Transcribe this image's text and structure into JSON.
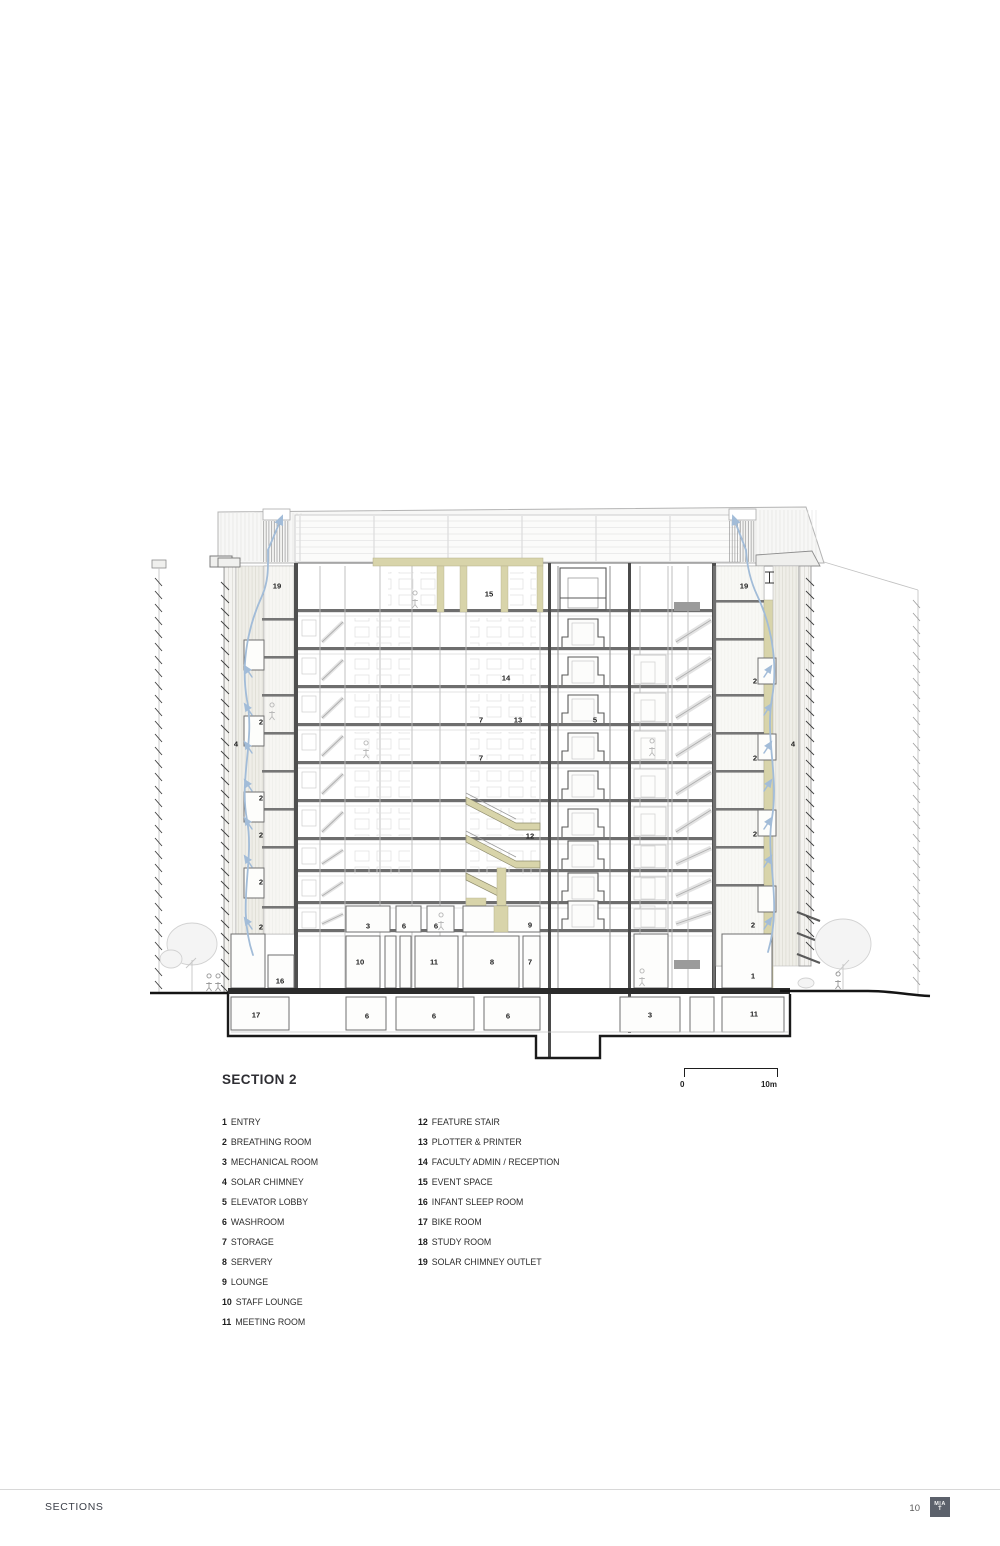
{
  "drawing": {
    "title": "SECTION 2",
    "scale_bar": {
      "start_label": "0",
      "end_label": "10m"
    },
    "colors": {
      "timber": "#d8d4aa",
      "timber_edge": "#b4b08c",
      "airflow": "#a2bcd8",
      "cut_wall": "#4f4f4f",
      "light_line": "#bcbcbc",
      "ground": "#1a1a1a"
    },
    "labels": [
      {
        "t": "19",
        "x": 277,
        "y": 586
      },
      {
        "t": "19",
        "x": 744,
        "y": 586
      },
      {
        "t": "15",
        "x": 489,
        "y": 594
      },
      {
        "t": "14",
        "x": 506,
        "y": 678
      },
      {
        "t": "2",
        "x": 261,
        "y": 722
      },
      {
        "t": "7",
        "x": 481,
        "y": 720
      },
      {
        "t": "13",
        "x": 518,
        "y": 720
      },
      {
        "t": "5",
        "x": 595,
        "y": 720
      },
      {
        "t": "2",
        "x": 755,
        "y": 681
      },
      {
        "t": "4",
        "x": 236,
        "y": 744
      },
      {
        "t": "4",
        "x": 793,
        "y": 744
      },
      {
        "t": "7",
        "x": 481,
        "y": 758
      },
      {
        "t": "2",
        "x": 755,
        "y": 758
      },
      {
        "t": "2",
        "x": 261,
        "y": 798
      },
      {
        "t": "12",
        "x": 530,
        "y": 836
      },
      {
        "t": "2",
        "x": 261,
        "y": 835
      },
      {
        "t": "2",
        "x": 755,
        "y": 834
      },
      {
        "t": "2",
        "x": 261,
        "y": 882
      },
      {
        "t": "2",
        "x": 261,
        "y": 927
      },
      {
        "t": "3",
        "x": 368,
        "y": 926
      },
      {
        "t": "6",
        "x": 404,
        "y": 926
      },
      {
        "t": "6",
        "x": 436,
        "y": 926
      },
      {
        "t": "9",
        "x": 530,
        "y": 925
      },
      {
        "t": "2",
        "x": 753,
        "y": 925
      },
      {
        "t": "10",
        "x": 360,
        "y": 962
      },
      {
        "t": "11",
        "x": 434,
        "y": 962
      },
      {
        "t": "8",
        "x": 492,
        "y": 962
      },
      {
        "t": "7",
        "x": 530,
        "y": 962
      },
      {
        "t": "1",
        "x": 753,
        "y": 976
      },
      {
        "t": "16",
        "x": 280,
        "y": 981
      },
      {
        "t": "17",
        "x": 256,
        "y": 1015
      },
      {
        "t": "6",
        "x": 367,
        "y": 1016
      },
      {
        "t": "6",
        "x": 434,
        "y": 1016
      },
      {
        "t": "6",
        "x": 508,
        "y": 1016
      },
      {
        "t": "3",
        "x": 650,
        "y": 1015
      },
      {
        "t": "11",
        "x": 754,
        "y": 1014
      }
    ]
  },
  "legend": {
    "columns": [
      {
        "items": [
          {
            "num": "1",
            "label": "ENTRY"
          },
          {
            "num": "2",
            "label": "BREATHING ROOM"
          },
          {
            "num": "3",
            "label": "MECHANICAL ROOM"
          },
          {
            "num": "4",
            "label": "SOLAR CHIMNEY"
          },
          {
            "num": "5",
            "label": "ELEVATOR LOBBY"
          },
          {
            "num": "6",
            "label": "WASHROOM"
          },
          {
            "num": "7",
            "label": "STORAGE"
          },
          {
            "num": "8",
            "label": "SERVERY"
          },
          {
            "num": "9",
            "label": "LOUNGE"
          },
          {
            "num": "10",
            "label": "STAFF LOUNGE"
          },
          {
            "num": "11",
            "label": "MEETING ROOM"
          }
        ]
      },
      {
        "items": [
          {
            "num": "12",
            "label": "FEATURE STAIR"
          },
          {
            "num": "13",
            "label": "PLOTTER & PRINTER"
          },
          {
            "num": "14",
            "label": "FACULTY ADMIN / RECEPTION"
          },
          {
            "num": "15",
            "label": "EVENT SPACE"
          },
          {
            "num": "16",
            "label": "INFANT SLEEP ROOM"
          },
          {
            "num": "17",
            "label": "BIKE ROOM"
          },
          {
            "num": "18",
            "label": "STUDY ROOM"
          },
          {
            "num": "19",
            "label": "SOLAR CHIMNEY OUTLET"
          }
        ]
      }
    ]
  },
  "footer": {
    "section_label": "SECTIONS",
    "page_number": "10",
    "logo_line1": "M|A",
    "logo_line2": "T"
  }
}
